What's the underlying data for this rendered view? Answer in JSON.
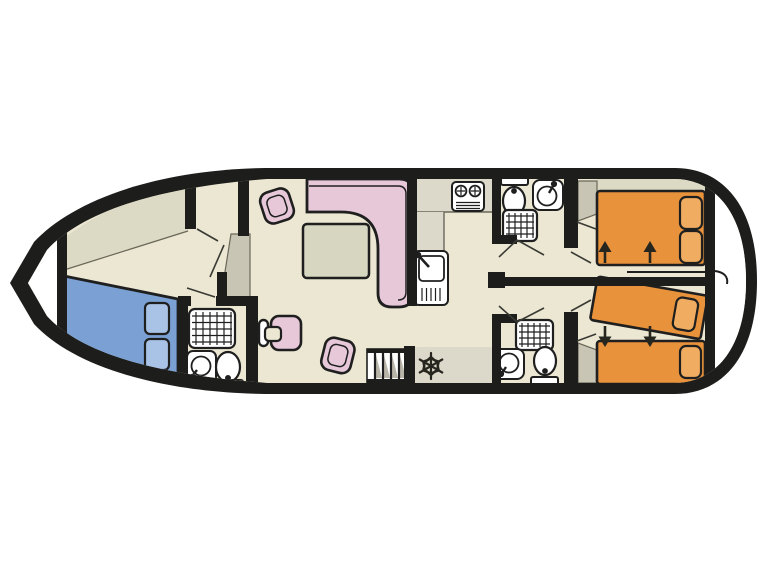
{
  "diagram": {
    "type": "boat-deck-floor-plan",
    "orientation": {
      "bow": "left",
      "stern": "right"
    },
    "rooms": [
      {
        "name": "bow-locker",
        "contents": []
      },
      {
        "name": "bow-cabin",
        "contents": [
          "double-bed-blue",
          "two-pillows",
          "wardrobe"
        ]
      },
      {
        "name": "bow-bathroom",
        "contents": [
          "shower",
          "washbasin",
          "toilet"
        ]
      },
      {
        "name": "saloon",
        "contents": [
          "l-shaped-sofa",
          "table",
          "armchair",
          "armchair",
          "helm-seat",
          "steering-wheel",
          "stairs"
        ]
      },
      {
        "name": "galley",
        "contents": [
          "stove-two-burners",
          "sink-with-drainer",
          "fridge-freezer-snowflake"
        ]
      },
      {
        "name": "mid-bathroom-top",
        "contents": [
          "toilet",
          "washbasin",
          "shower"
        ]
      },
      {
        "name": "mid-bathroom-bottom",
        "contents": [
          "shower",
          "washbasin",
          "toilet"
        ]
      },
      {
        "name": "aft-cabin-top",
        "contents": [
          "double-bed-orange",
          "two-pillows",
          "wardrobe"
        ],
        "annotations": [
          "two-arrows-up",
          "slide-track"
        ]
      },
      {
        "name": "aft-cabin-bottom",
        "contents": [
          "single-bed-orange",
          "angled-convertible-bed-orange",
          "pillows",
          "wardrobe"
        ],
        "annotations": [
          "two-arrows-down"
        ]
      }
    ],
    "annotations": {
      "up_arrows": 2,
      "down_arrows": 2,
      "snowflake": "freezer",
      "stair_steps": 4
    }
  },
  "colors": {
    "background": "#ffffff",
    "hull_outline": "#1d1d1b",
    "wall": "#1d1d1b",
    "floor": "#ebe7d2",
    "floor_shaded": "#dcd9c4",
    "counter": "#dcd9ca",
    "wardrobe": "#c8c5b5",
    "exterior": "#ffffff",
    "bed_blue": "#7aa0d4",
    "pillow_blue": "#a9c3e6",
    "bed_orange": "#e8923c",
    "pillow_orange": "#f0ad62",
    "sofa_pink": "#e6c8d8",
    "table_top": "#d6d6c1",
    "fixture": "#ffffff",
    "outline": "#1f1f1f",
    "detail": "#26261f",
    "shadow": "#b9b6a9",
    "edge_line": "#6a675a",
    "door_line": "#3a3a35"
  }
}
